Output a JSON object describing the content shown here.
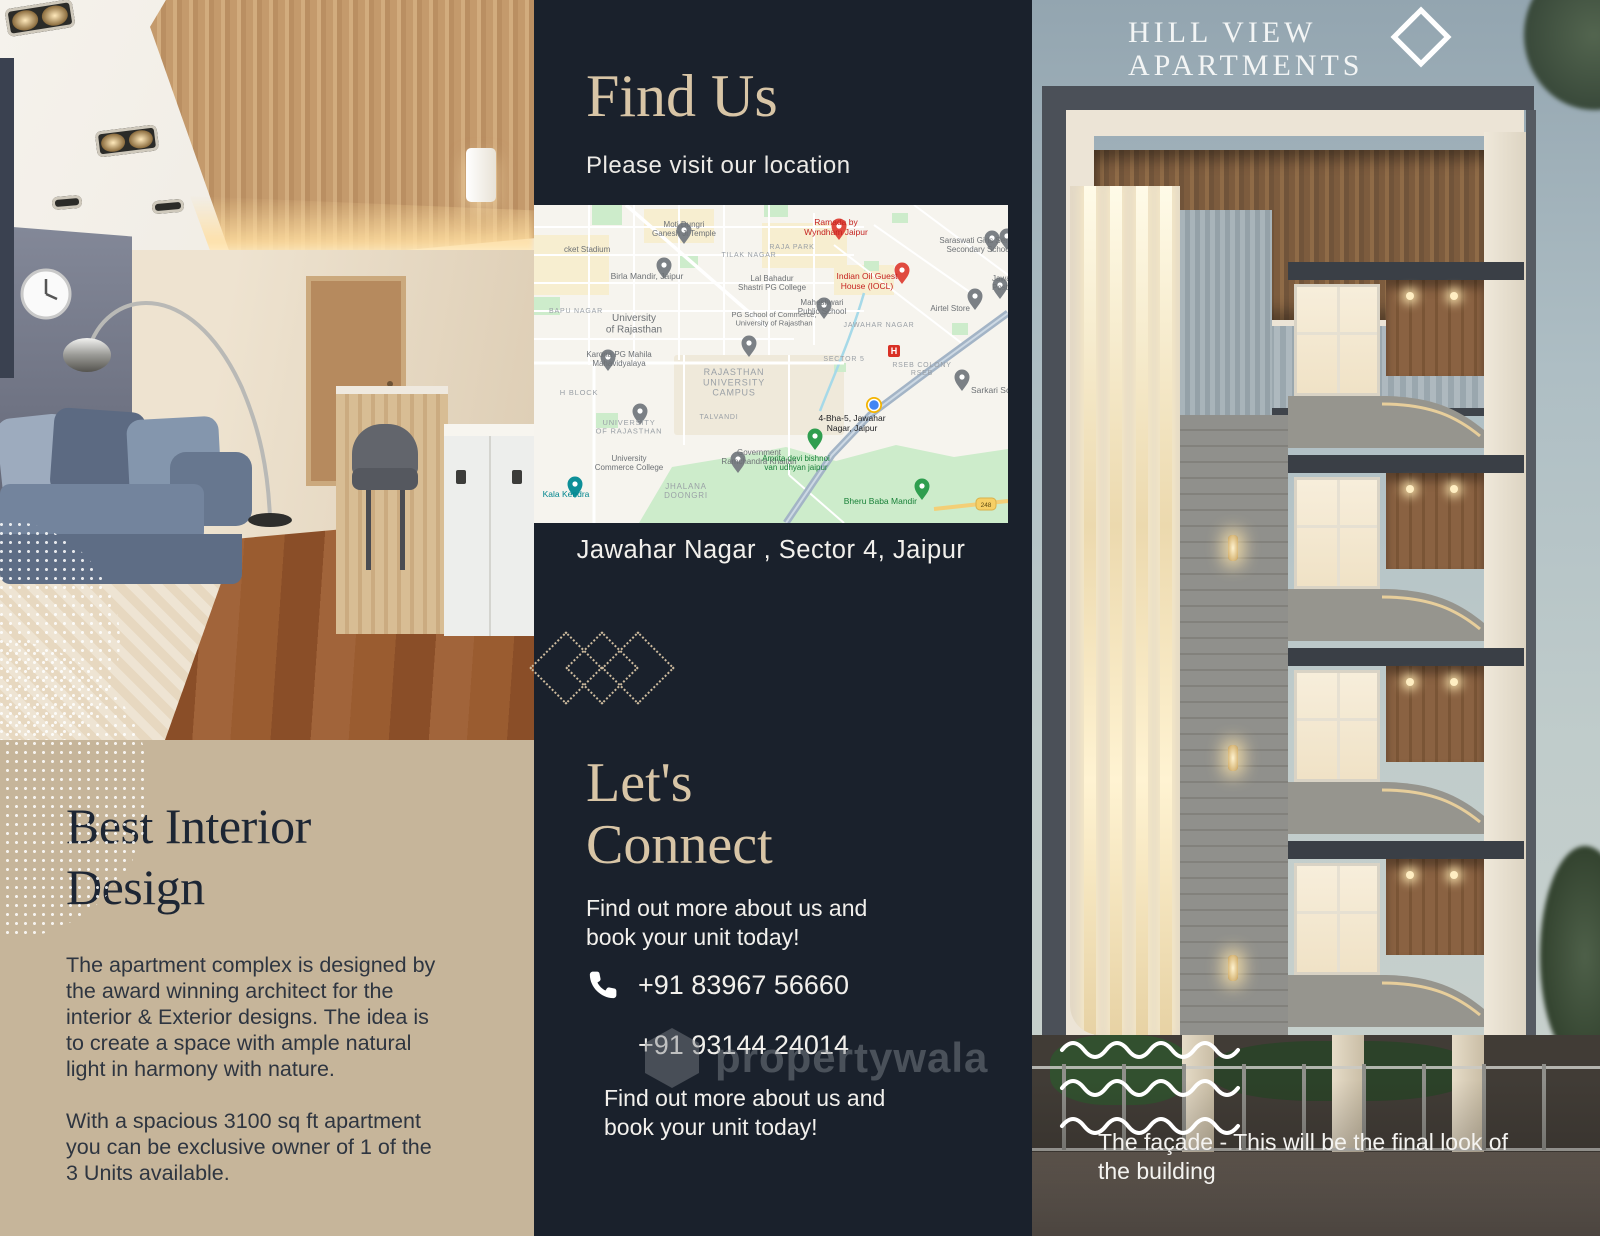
{
  "colors": {
    "panel_navy": "#1a212c",
    "panel_tan": "#c6b59a",
    "accent_tan": "#d8c5a6"
  },
  "left_panel": {
    "heading": "Best Interior Design",
    "paragraphs": [
      "The apartment complex is designed by the award winning architect for the interior & Exterior designs. The idea is to create a space with ample natural light in harmony with nature.",
      "With a spacious 3100 sq ft apartment you can be exclusive owner of 1 of the 3 Units available."
    ]
  },
  "middle_panel": {
    "find_us": {
      "title": "Find Us",
      "subtitle": "Please visit our location",
      "address": "Jawahar Nagar , Sector 4, Jaipur"
    },
    "connect": {
      "title_lines": [
        "Let's",
        "Connect"
      ],
      "blurb": "Find out more about us and book your unit today!",
      "phones": [
        "+91 83967 56660",
        "+91 93144 24014"
      ],
      "blurb2": "Find out more about us and book your unit today!"
    },
    "map": {
      "palette": {
        "gray": "#6d7175",
        "area": "#9aa0a6",
        "red": "#c5221f",
        "teal": "#01858e",
        "dark": "#202124",
        "green": "#188038"
      },
      "marker_palette": {
        "gray": "#7b8085",
        "red": "#e04a3f",
        "teal": "#0d8f98",
        "green": "#2f9e4f",
        "blue": "#4285f4"
      },
      "labels": [
        {
          "x": 30,
          "y": 47,
          "t": "cket Stadium",
          "c": "gray",
          "s": 8,
          "a": "start"
        },
        {
          "x": 150,
          "y": 22,
          "t": "Moti Dungri|Ganesh Ji Temple",
          "c": "gray",
          "s": 8
        },
        {
          "x": 215,
          "y": 52,
          "t": "TILAK NAGAR",
          "c": "area",
          "s": 7,
          "caps": true
        },
        {
          "x": 113,
          "y": 74,
          "t": "Birla Mandir, Jaipur",
          "c": "gray",
          "s": 8.5
        },
        {
          "x": 302,
          "y": 20,
          "t": "Ramada by|Wyndham Jaipur",
          "c": "red",
          "s": 8.5
        },
        {
          "x": 258,
          "y": 44,
          "t": "RAJA PARK",
          "c": "area",
          "s": 7,
          "caps": true
        },
        {
          "x": 445,
          "y": 38,
          "t": "Saraswati Girls Senior|Secondary School",
          "c": "gray",
          "s": 8
        },
        {
          "x": 238,
          "y": 76,
          "t": "Lal Bahadur|Shastri PG College",
          "c": "gray",
          "s": 8
        },
        {
          "x": 333,
          "y": 74,
          "t": "Indian Oil Guest|House (IOCL)",
          "c": "red",
          "s": 8.5
        },
        {
          "x": 458,
          "y": 76,
          "t": "Jawahar Nagar|Post Office",
          "c": "gray",
          "s": 8,
          "a": "start"
        },
        {
          "x": 240,
          "y": 112,
          "t": "PG School of Commerce,|University of Rajasthan",
          "c": "gray",
          "s": 7.5
        },
        {
          "x": 288,
          "y": 100,
          "t": "Maheshwari|Public School",
          "c": "gray",
          "s": 8
        },
        {
          "x": 436,
          "y": 106,
          "t": "Airtel Store",
          "c": "gray",
          "s": 8,
          "a": "end"
        },
        {
          "x": 345,
          "y": 122,
          "t": "JAWAHAR NAGAR",
          "c": "area",
          "s": 7,
          "caps": true
        },
        {
          "x": 100,
          "y": 116,
          "t": "University|of Rajasthan",
          "c": "gray",
          "s": 10
        },
        {
          "x": 42,
          "y": 108,
          "t": "BAPU NAGAR",
          "c": "area",
          "s": 7,
          "caps": true
        },
        {
          "x": 310,
          "y": 156,
          "t": "SECTOR 5",
          "c": "area",
          "s": 7,
          "caps": true
        },
        {
          "x": 388,
          "y": 162,
          "t": "RSEB COLONY|RSEB",
          "c": "area",
          "s": 7,
          "caps": true
        },
        {
          "x": 437,
          "y": 188,
          "t": "Sarkari School",
          "c": "gray",
          "s": 8.5,
          "a": "start"
        },
        {
          "x": 85,
          "y": 152,
          "t": "Karona PG Mahila|Mahavidyalaya",
          "c": "gray",
          "s": 8
        },
        {
          "x": 45,
          "y": 190,
          "t": "H BLOCK",
          "c": "area",
          "s": 7.5,
          "caps": true
        },
        {
          "x": 200,
          "y": 170,
          "t": "RAJASTHAN|UNIVERSITY|CAMPUS",
          "c": "area",
          "s": 9,
          "caps": true
        },
        {
          "x": 185,
          "y": 214,
          "t": "TALVANDI",
          "c": "area",
          "s": 7,
          "caps": true
        },
        {
          "x": 95,
          "y": 220,
          "t": "UNIVERSITY|OF RAJASTHAN",
          "c": "area",
          "s": 7.5,
          "caps": true
        },
        {
          "x": 225,
          "y": 250,
          "t": "Government|Ramchandra Khaitan",
          "c": "gray",
          "s": 8
        },
        {
          "x": 95,
          "y": 256,
          "t": "University|Commerce College",
          "c": "gray",
          "s": 8
        },
        {
          "x": 152,
          "y": 284,
          "t": "JHALANA|DOONGRI",
          "c": "area",
          "s": 8,
          "caps": true
        },
        {
          "x": 32,
          "y": 292,
          "t": "Kala Kendra",
          "c": "teal",
          "s": 8.5
        },
        {
          "x": 262,
          "y": 256,
          "t": "Amrita devi bishnoi|van udhyan jaipur",
          "c": "green",
          "s": 8
        },
        {
          "x": 383,
          "y": 299,
          "t": "Bheru Baba Mandir",
          "c": "green",
          "s": 8.5,
          "a": "end"
        },
        {
          "x": 318,
          "y": 216,
          "t": "4-Bha-5, Jawahar|Nagar, Jaipur",
          "c": "dark",
          "s": 8.5
        }
      ],
      "markers": [
        {
          "x": 150,
          "y": 37,
          "k": "pin",
          "c": "gray"
        },
        {
          "x": 130,
          "y": 72,
          "k": "pin",
          "c": "gray"
        },
        {
          "x": 458,
          "y": 45,
          "k": "pin",
          "c": "gray"
        },
        {
          "x": 473,
          "y": 43,
          "k": "pin",
          "c": "gray"
        },
        {
          "x": 466,
          "y": 92,
          "k": "pin",
          "c": "gray"
        },
        {
          "x": 290,
          "y": 112,
          "k": "pin",
          "c": "gray"
        },
        {
          "x": 215,
          "y": 150,
          "k": "pin",
          "c": "gray"
        },
        {
          "x": 74,
          "y": 164,
          "k": "pin",
          "c": "gray"
        },
        {
          "x": 106,
          "y": 218,
          "k": "pin",
          "c": "gray"
        },
        {
          "x": 204,
          "y": 266,
          "k": "pin",
          "c": "gray"
        },
        {
          "x": 441,
          "y": 103,
          "k": "pin",
          "c": "gray"
        },
        {
          "x": 428,
          "y": 184,
          "k": "pin",
          "c": "gray"
        },
        {
          "x": 41,
          "y": 291,
          "k": "pin",
          "c": "teal"
        },
        {
          "x": 281,
          "y": 243,
          "k": "pin",
          "c": "green"
        },
        {
          "x": 388,
          "y": 293,
          "k": "pin",
          "c": "green"
        },
        {
          "x": 305,
          "y": 33,
          "k": "pin",
          "c": "red"
        },
        {
          "x": 368,
          "y": 77,
          "k": "pin",
          "c": "red"
        },
        {
          "x": 360,
          "y": 146,
          "k": "h"
        },
        {
          "x": 340,
          "y": 200,
          "k": "dot"
        },
        {
          "x": 452,
          "y": 299,
          "k": "badge",
          "text": "248"
        }
      ]
    }
  },
  "right_panel": {
    "brand": {
      "line1": "HILL VIEW",
      "line2": "APARTMENTS"
    },
    "caption": "The façade - This will be the final look of the building"
  },
  "watermark": {
    "text": "propertywala"
  }
}
